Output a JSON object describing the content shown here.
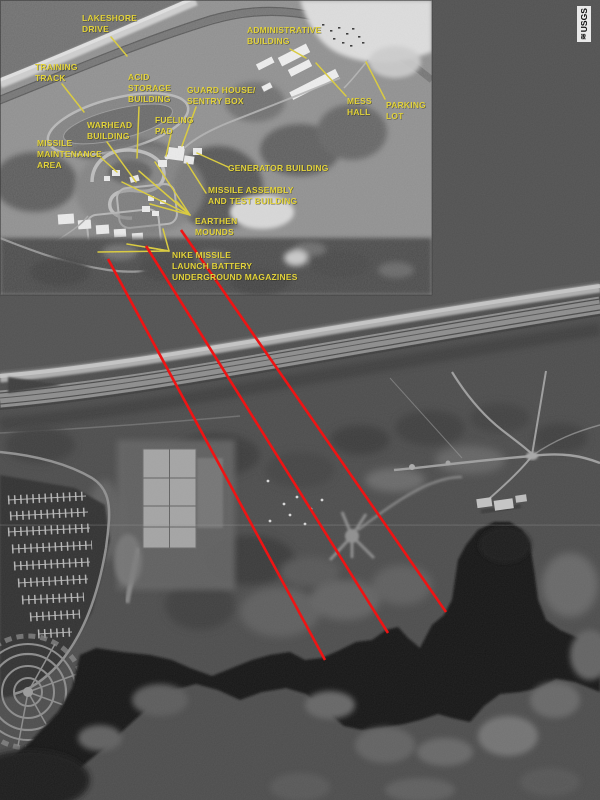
{
  "colors": {
    "label": "#e3d33c",
    "leader": "#dccc33",
    "marker": "#ee1414",
    "photo": "#4d4d4d"
  },
  "inset": {
    "description": "aerial-photo-inset-nike-missile-site",
    "labels": {
      "lakeshore_drive": "LAKESHORE\nDRIVE",
      "training_track": "TRAINING\nTRACK",
      "administrative_building": "ADMINISTRATIVE\nBUILDING",
      "acid_storage_building": "ACID\nSTORAGE\nBUILDING",
      "guard_house_sentry_box": "GUARD HOUSE/\nSENTRY BOX",
      "mess_hall": "MESS\nHALL",
      "parking_lot": "PARKING\nLOT",
      "fueling_pad": "FUELING\nPAD",
      "warhead_building": "WARHEAD\nBUILDING",
      "missile_maintenance_area": "MISSILE\nMAINTENANCE\nAREA",
      "generator_building": "GENERATOR BUILDING",
      "missile_assembly": "MISSILE ASSEMBLY\nAND TEST BUILDING",
      "earthen_mounds": "EARTHEN\nMOUNDS",
      "nike_missile_magazines": "NIKE MISSILE\nLAUNCH BATTERY\nUNDERGROUND MAGAZINES"
    }
  },
  "watermark": {
    "agency": "USGS",
    "glyph": "≋"
  }
}
